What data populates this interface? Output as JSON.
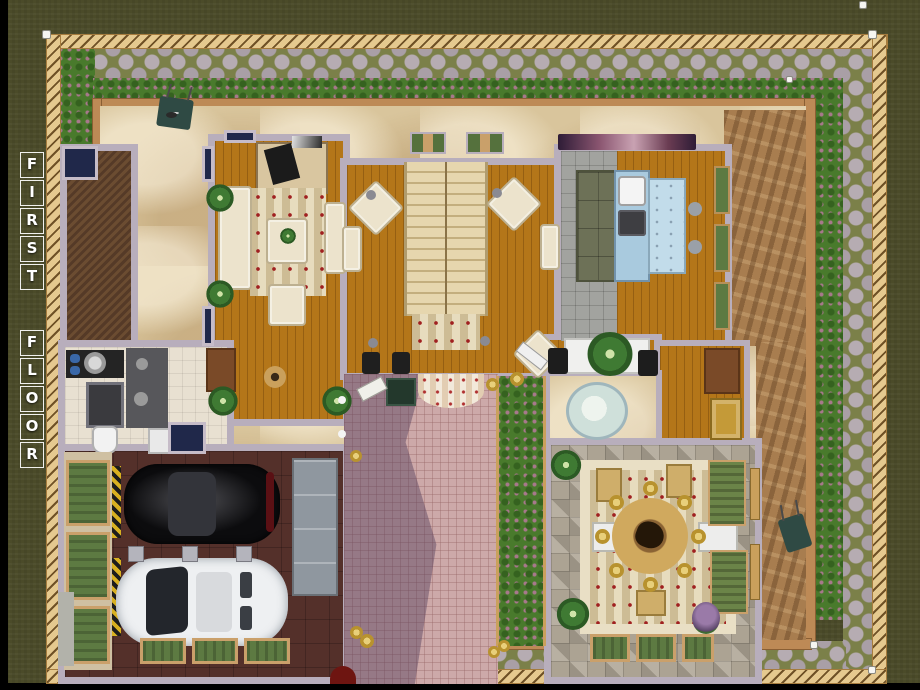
{
  "title": {
    "text": "FIRST FLOOR",
    "letters": [
      "F",
      "I",
      "R",
      "S",
      "T",
      "F",
      "L",
      "O",
      "O",
      "R"
    ]
  },
  "palette": {
    "grass": "#4b4b29",
    "fence_wood": "#e5c98f",
    "path_green": "#7b8049",
    "cobblestone": "#b6acb2",
    "hedge_green": "#497a2c",
    "hedge_berry": "#a8788c",
    "sand": "#d9c59c",
    "dirt": "#a87d4f",
    "garden_wall": "#bd8a56",
    "house_wall": "#b8aebc",
    "wood_floor": "#b47619",
    "garage_floor": "#54302a",
    "porch_tile": "#cda9a9",
    "porch_shadow": "#543e5c",
    "stone_tile": "#aca393",
    "bath_tile": "#e8e0d1",
    "kitchen_tile": "#a2a39f",
    "stair_wood": "#e6d6ae",
    "counter_blue": "#a9cade",
    "window_navy": "#20284a",
    "curtain_green": "#55713d",
    "cream_furniture": "#ece3cc",
    "rug_stripe": "#cdbc95",
    "gold": "#c9a236",
    "car_black": "#0c0c0e",
    "car_white": "#eef0f2",
    "label_text": "#ffffff"
  }
}
